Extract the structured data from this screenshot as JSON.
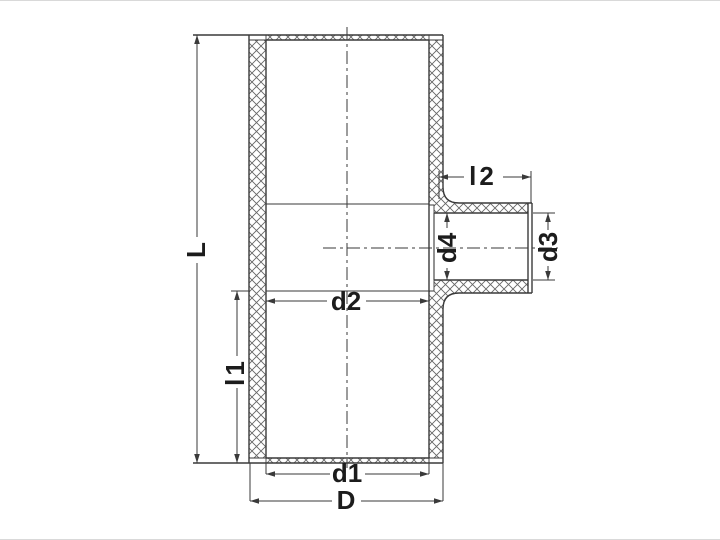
{
  "diagram": {
    "subject": "Reducing tee pipe fitting - sectional technical drawing",
    "view": "cross-section with crosshatched walls",
    "colors": {
      "line": "#3a3a3a",
      "hatch": "#666666",
      "background": "#ffffff"
    },
    "labels": {
      "L": "L",
      "l1": "l1",
      "l2": "l2",
      "d1": "d1",
      "d2": "d2",
      "d3": "d3",
      "d4": "d4",
      "D": "D"
    }
  }
}
